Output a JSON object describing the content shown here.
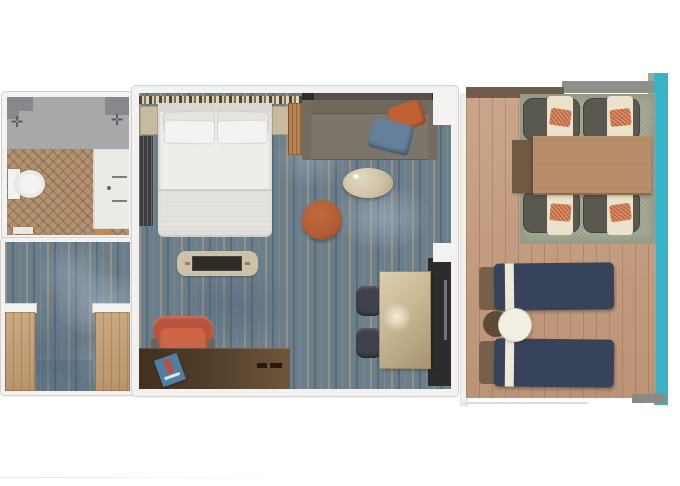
{
  "canvas": {
    "width": 680,
    "height": 486,
    "background": "#ffffff"
  },
  "plan": {
    "type": "stateroom-floor-plan-top-view",
    "rooms": {
      "bathroom": {
        "items": [
          "shower",
          "shower-fixture-left",
          "shower-fixture-right",
          "toilet",
          "vanity",
          "bath-mat",
          "door-threshold",
          "herringbone-floor"
        ]
      },
      "entry_corridor": {
        "items": [
          "carpet-runner",
          "closet-left",
          "closet-right"
        ]
      },
      "bedroom": {
        "items": [
          "king-bed",
          "pillows",
          "headboard-mosaic",
          "nightstand-left",
          "nightstand-right",
          "open-wardrobe",
          "wood-wardrobe",
          "sofa",
          "throw-pillow-orange",
          "throw-pillow-blue",
          "oval-coffee-table",
          "ottoman",
          "tv-console",
          "tv",
          "desk",
          "desk-chair",
          "magazine",
          "window-table",
          "window-chair-upper",
          "window-chair-lower",
          "picture-window"
        ]
      },
      "balcony": {
        "items": [
          "wood-deck",
          "outdoor-rug",
          "dining-table",
          "dining-chair-1",
          "dining-chair-2",
          "dining-chair-3",
          "dining-chair-4",
          "sun-lounger-1",
          "sun-lounger-2",
          "side-table",
          "railing",
          "sea-edge"
        ]
      }
    }
  },
  "colors": {
    "wall": "#f3f2f1",
    "wallEdge": "#d2d1cf",
    "showerGrey": "#a8a8aa",
    "showerDark": "#88888c",
    "fixture": "#55555c",
    "bathFloor": "#b29271",
    "vanity": "#eceae7",
    "toiletWhite": "#f4f3f1",
    "woodEntry": "#c49e73",
    "carpet": "#6d7e8b",
    "mosaicDark": "#4a4740",
    "mosaicGold": "#d8cba8",
    "bedWhite": "#efedea",
    "bedShadow": "#dbd8d4",
    "nightstand": "#c6baa1",
    "wardrobeDark": "#3b3d41",
    "woodWardrobe": "#b5834f",
    "sofa": "#7d7569",
    "sofaBack": "#6f685e",
    "pillowOrange": "#bf6134",
    "pillowBlue": "#65809a",
    "ovalTable": "#cfc3a8",
    "ottoman": "#b25c36",
    "console": "#cdc2a8",
    "tv": "#2e2b28",
    "desk": "#503c29",
    "deskLight": "#6f563c",
    "chairOrange": "#cd6548",
    "windowDark": "#2c2c2e",
    "windowTable": "#c9b795",
    "chairDark": "#3f424a",
    "deck": "#c59b7d",
    "rug": "#a6aa97",
    "rugEdge": "#979b88",
    "balTable": "#b68b68",
    "balTableDark": "#705842",
    "balChair": "#5a5950",
    "towel": "#ece2cb",
    "balPillow": "#c36a41",
    "lounger": "#37435a",
    "loungerStripe": "#efe8d6",
    "loungerWood": "#77604a",
    "sideTable": "#f4efe3",
    "sideTableDark": "#5f4a38",
    "teal": "#38b3c5",
    "railGrey": "#a3a39b",
    "topBarBrown": "#6f5c4a",
    "topBarGrey": "#90908a",
    "magBlue": "#4f7fa0",
    "magRed": "#c34b3a"
  }
}
